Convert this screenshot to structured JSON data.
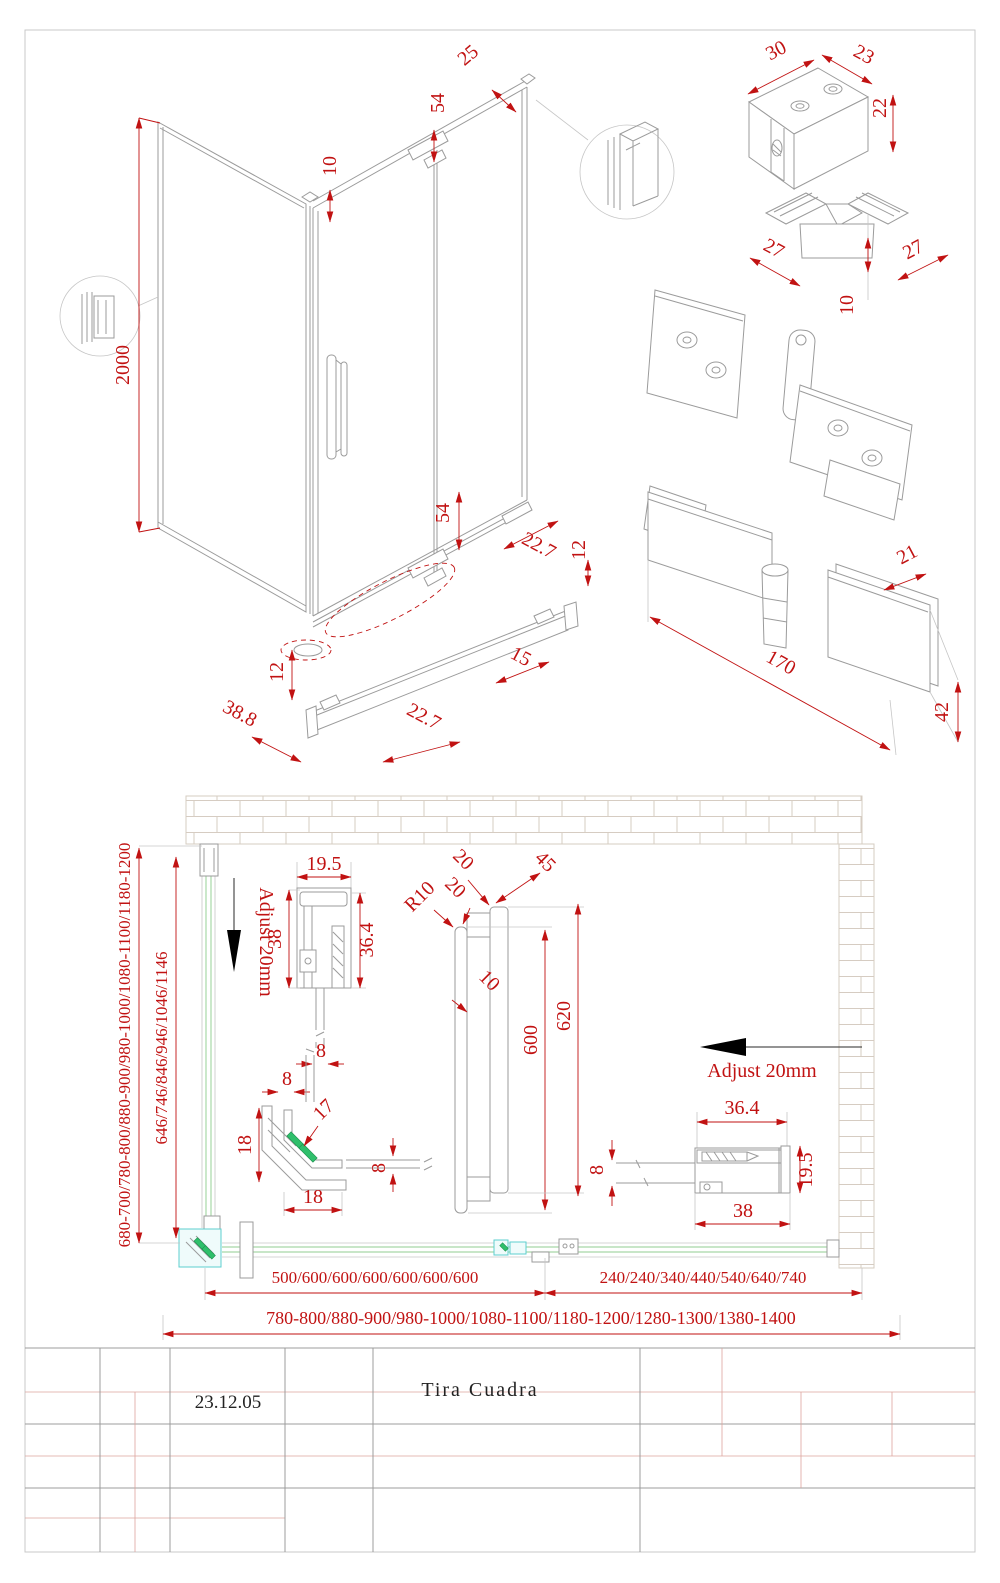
{
  "title_block": {
    "date": "23.12.05",
    "product_name": "Tira Cuadra"
  },
  "colors": {
    "dimension_red": "#c11212",
    "drawing_line": "#9b9b9b",
    "glass_green": "#a8d8a8",
    "hardware_highlight": "#5ecfcf",
    "seal_green": "#2fbf6b",
    "brick_line": "#d6ccc2",
    "grid_red": "#dda49e",
    "grid_gray": "#9c9c9c",
    "arrow_black": "#000000"
  },
  "iso_view": {
    "height": "2000",
    "glass_gap": "10",
    "top_frame": "54",
    "profile_width": "25",
    "bottom_frame": "54",
    "edge_seal": "22.7",
    "edge_height": "12",
    "rail_clip": "15",
    "rail_seal": "22.7",
    "rail_height": "12",
    "rail_depth": "38.8"
  },
  "corner_block": {
    "width": "30",
    "depth": "23",
    "height": "22"
  },
  "corner_connector": {
    "arm_a": "27",
    "arm_b": "27",
    "height": "10"
  },
  "wall_hinge": {
    "plate_width": "21",
    "length": "170",
    "height": "42"
  },
  "plan_view": {
    "side_range": "680-700/780-800/880-900/980-1000/1080-1100/1180-1200",
    "side_glass": "646/746/846/946/1046/1146",
    "adjust_left": "Adjust 20mm",
    "adjust_right": "Adjust 20mm",
    "wall_profile": {
      "width": "19.5",
      "depth": "38",
      "inner_depth": "36.4",
      "glass_a": "8",
      "glass_b": "8"
    },
    "corner_profile": {
      "side_a": "18",
      "diagonal": "17",
      "side_b": "18",
      "glass": "8"
    },
    "handle": {
      "tube_a": "20",
      "tube_b": "20",
      "offset": "45",
      "radius": "R10",
      "thickness": "10",
      "grip_length": "600",
      "total_length": "620",
      "glass": "8"
    },
    "right_wall_profile": {
      "inner_depth": "36.4",
      "width": "19.5",
      "depth": "38"
    },
    "door_widths": "500/600/600/600/600/600/600",
    "panel_widths": "240/240/340/440/540/640/740",
    "total_range": "780-800/880-900/980-1000/1080-1100/1180-1200/1280-1300/1380-1400"
  }
}
